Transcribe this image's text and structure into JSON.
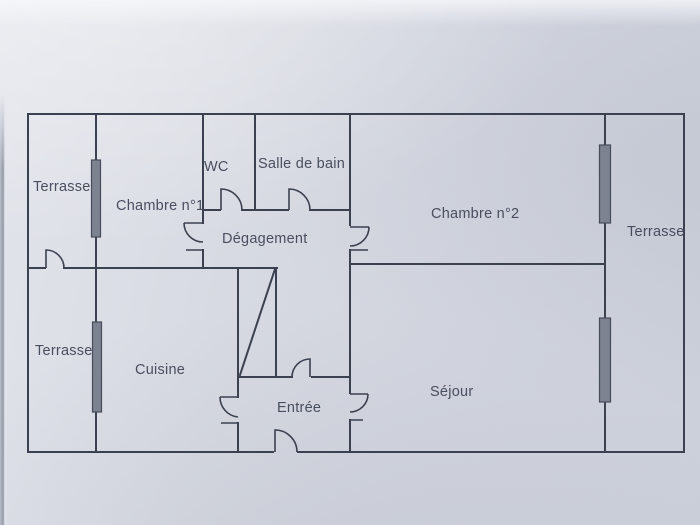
{
  "document": {
    "kind": "apartment floor plan (photographed paper drawing)",
    "language": "fr"
  },
  "palette": {
    "paper": "#d5d8e1",
    "paper_highlight": "#e9ebf1",
    "paper_shadow": "#ccd0da",
    "wall_line": "#3c4150",
    "label_text": "#424758",
    "window_fill": "#7c8290",
    "window_border": "#474c59",
    "page_seam": "#9299a7"
  },
  "rooms": [
    {
      "id": "terrace-upper-left",
      "label": "Terrasse"
    },
    {
      "id": "bedroom-1",
      "label": "Chambre n°1"
    },
    {
      "id": "wc",
      "label": "WC"
    },
    {
      "id": "bathroom",
      "label": "Salle de bain"
    },
    {
      "id": "bedroom-2",
      "label": "Chambre n°2"
    },
    {
      "id": "terrace-right",
      "label": "Terrasse"
    },
    {
      "id": "hallway",
      "label": "Dégagement"
    },
    {
      "id": "terrace-lower-left",
      "label": "Terrasse"
    },
    {
      "id": "kitchen",
      "label": "Cuisine"
    },
    {
      "id": "entry",
      "label": "Entrée"
    },
    {
      "id": "living-room",
      "label": "Séjour"
    }
  ]
}
